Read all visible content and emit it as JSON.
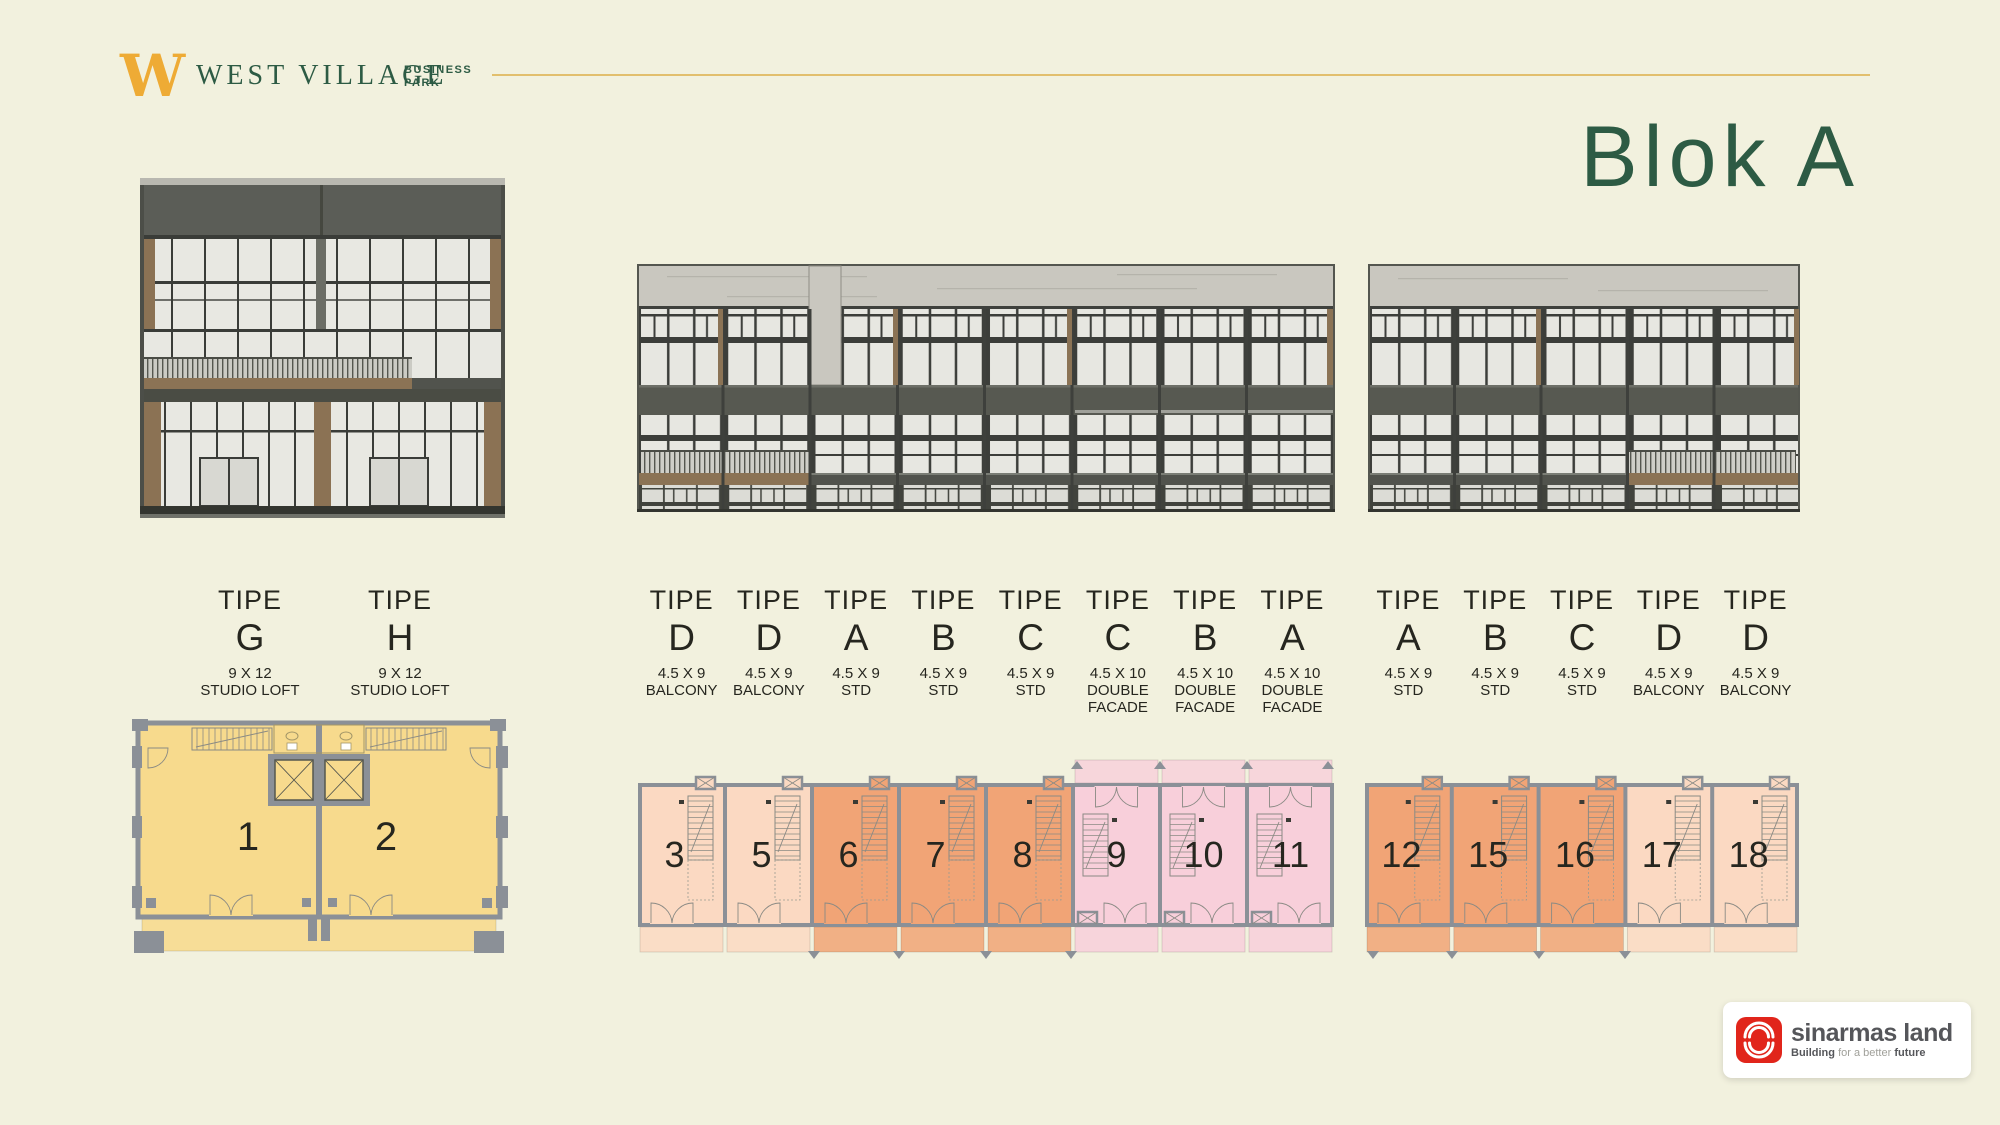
{
  "brand": {
    "logo_letter": "W",
    "name": "WEST VILLAGE",
    "sub_line1": "BUSINESS",
    "sub_line2": "PARK"
  },
  "title": "Blok A",
  "type_label_word": "TIPE",
  "type_groups": {
    "left": [
      {
        "letter": "G",
        "size": "9 X 12",
        "desc": "STUDIO LOFT"
      },
      {
        "letter": "H",
        "size": "9 X 12",
        "desc": "STUDIO LOFT"
      }
    ],
    "middle": [
      {
        "letter": "D",
        "size": "4.5 X 9",
        "desc": "BALCONY"
      },
      {
        "letter": "D",
        "size": "4.5 X 9",
        "desc": "BALCONY"
      },
      {
        "letter": "A",
        "size": "4.5 X 9",
        "desc": "STD"
      },
      {
        "letter": "B",
        "size": "4.5 X 9",
        "desc": "STD"
      },
      {
        "letter": "C",
        "size": "4.5 X 9",
        "desc": "STD"
      },
      {
        "letter": "C",
        "size": "4.5 X 10",
        "desc": "DOUBLE FACADE"
      },
      {
        "letter": "B",
        "size": "4.5 X 10",
        "desc": "DOUBLE FACADE"
      },
      {
        "letter": "A",
        "size": "4.5 X 10",
        "desc": "DOUBLE FACADE"
      }
    ],
    "right": [
      {
        "letter": "A",
        "size": "4.5 X 9",
        "desc": "STD"
      },
      {
        "letter": "B",
        "size": "4.5 X 9",
        "desc": "STD"
      },
      {
        "letter": "C",
        "size": "4.5 X 9",
        "desc": "STD"
      },
      {
        "letter": "D",
        "size": "4.5 X 9",
        "desc": "BALCONY"
      },
      {
        "letter": "D",
        "size": "4.5 X 9",
        "desc": "BALCONY"
      }
    ]
  },
  "plans": {
    "left": {
      "units": [
        {
          "no": "1",
          "cat": "yellow"
        },
        {
          "no": "2",
          "cat": "yellow"
        }
      ]
    },
    "middle": {
      "units": [
        {
          "no": "3",
          "cat": "light"
        },
        {
          "no": "5",
          "cat": "light"
        },
        {
          "no": "6",
          "cat": "orange"
        },
        {
          "no": "7",
          "cat": "orange"
        },
        {
          "no": "8",
          "cat": "orange"
        },
        {
          "no": "9",
          "cat": "pink"
        },
        {
          "no": "10",
          "cat": "pink"
        },
        {
          "no": "11",
          "cat": "pink"
        }
      ]
    },
    "right": {
      "units": [
        {
          "no": "12",
          "cat": "orange"
        },
        {
          "no": "15",
          "cat": "orange"
        },
        {
          "no": "16",
          "cat": "orange"
        },
        {
          "no": "17",
          "cat": "light"
        },
        {
          "no": "18",
          "cat": "light"
        }
      ]
    }
  },
  "palette": {
    "background": "#f2f1de",
    "green": "#2d5b44",
    "gold": "#e9b04a",
    "yellow": "#f7da8d",
    "light": "#fbd9c2",
    "orange": "#f1a476",
    "pink": "#f8cfda",
    "wall": "#8b9097",
    "label_dark": "#26261f"
  },
  "footer_logo": {
    "name": "sinarmas land",
    "tagline_bold1": "Building",
    "tagline_mid": "for a better",
    "tagline_bold2": "future"
  }
}
